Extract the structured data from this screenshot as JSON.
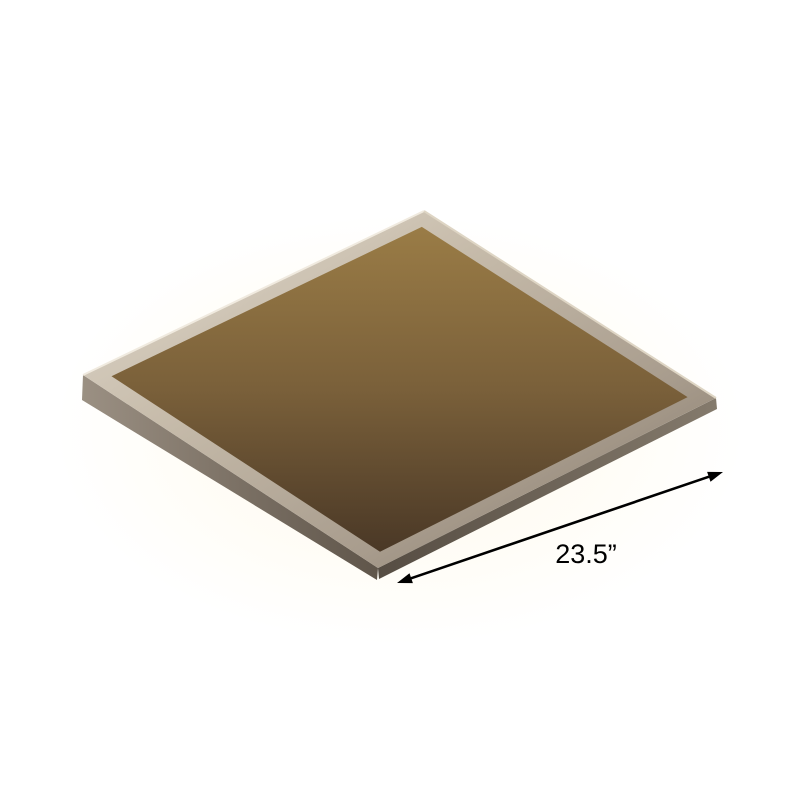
{
  "scene": {
    "type": "product-photo",
    "subject": "square crystal LED flush-mount ceiling light viewed from below",
    "background_color": "#ffffff"
  },
  "annotation": {
    "dimension_label": "23.5”",
    "label_color": "#000000",
    "arrow_color": "#000000"
  },
  "colors": {
    "canopy_chrome_light": "#dcd4c6",
    "canopy_chrome_mid": "#a89c8d",
    "canopy_chrome_dark": "#6f6457",
    "canopy_interior_gold": "#8a6f3e",
    "canopy_interior_dark": "#46362a",
    "crystal_bright": "#faf1cd",
    "crystal_mid": "#e9d193",
    "crystal_deep": "#caa45e",
    "led_glow": "#fff3c9"
  }
}
